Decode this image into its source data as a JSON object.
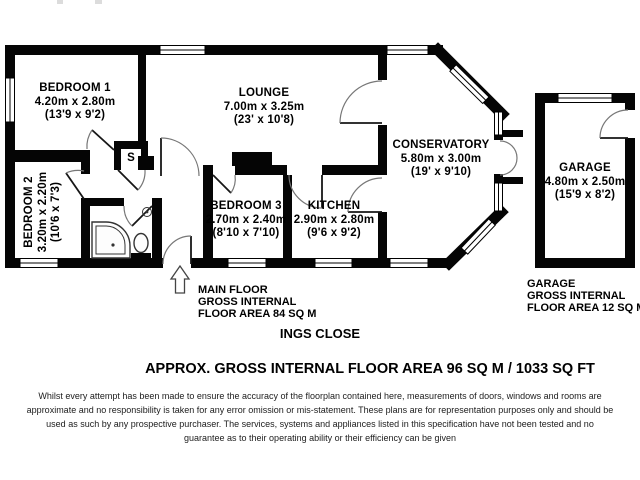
{
  "rooms": {
    "bedroom1": {
      "name": "BEDROOM 1",
      "metric": "4.20m x 2.80m",
      "imperial": "(13'9 x 9'2)"
    },
    "lounge": {
      "name": "LOUNGE",
      "metric": "7.00m x 3.25m",
      "imperial": "(23' x 10'8)"
    },
    "conservatory": {
      "name": "CONSERVATORY",
      "metric": "5.80m x 3.00m",
      "imperial": "(19' x 9'10)"
    },
    "bedroom2": {
      "name": "BEDROOM 2",
      "metric": "3.20m x 2.20m",
      "imperial": "(10'6 x 7'3)"
    },
    "bedroom3": {
      "name": "BEDROOM 3",
      "metric": "2.70m x 2.40m",
      "imperial": "(8'10 x 7'10)"
    },
    "kitchen": {
      "name": "KITCHEN",
      "metric": "2.90m x 2.80m",
      "imperial": "(9'6 x 9'2)"
    },
    "garage": {
      "name": "GARAGE",
      "metric": "4.80m x 2.50m",
      "imperial": "(15'9 x 8'2)"
    }
  },
  "store_label": "S",
  "captions": {
    "main_floor": [
      "MAIN FLOOR",
      "GROSS INTERNAL",
      "FLOOR AREA 84 SQ M"
    ],
    "garage": [
      "GARAGE",
      "GROSS INTERNAL",
      "FLOOR AREA 12 SQ M"
    ]
  },
  "title": "INGS CLOSE",
  "total_area_line": "APPROX. GROSS INTERNAL FLOOR AREA 96 SQ M / 1033 SQ FT",
  "disclaimer_lines": [
    "Whilst every attempt has been made to ensure the accuracy of the floorplan contained here, measurements of doors, windows and rooms are",
    "approximate and no responsibility is taken for any error omission or mis-statement. These plans are for representation purposes only and should be",
    "used as such by any prospective purchaser. The services, systems and appliances listed in this specification have not been tested and no",
    "guarantee as to their operating ability or their efficiency can be given"
  ],
  "colors": {
    "wall": "#050505",
    "background": "#ffffff",
    "door_arc": "#777777"
  }
}
